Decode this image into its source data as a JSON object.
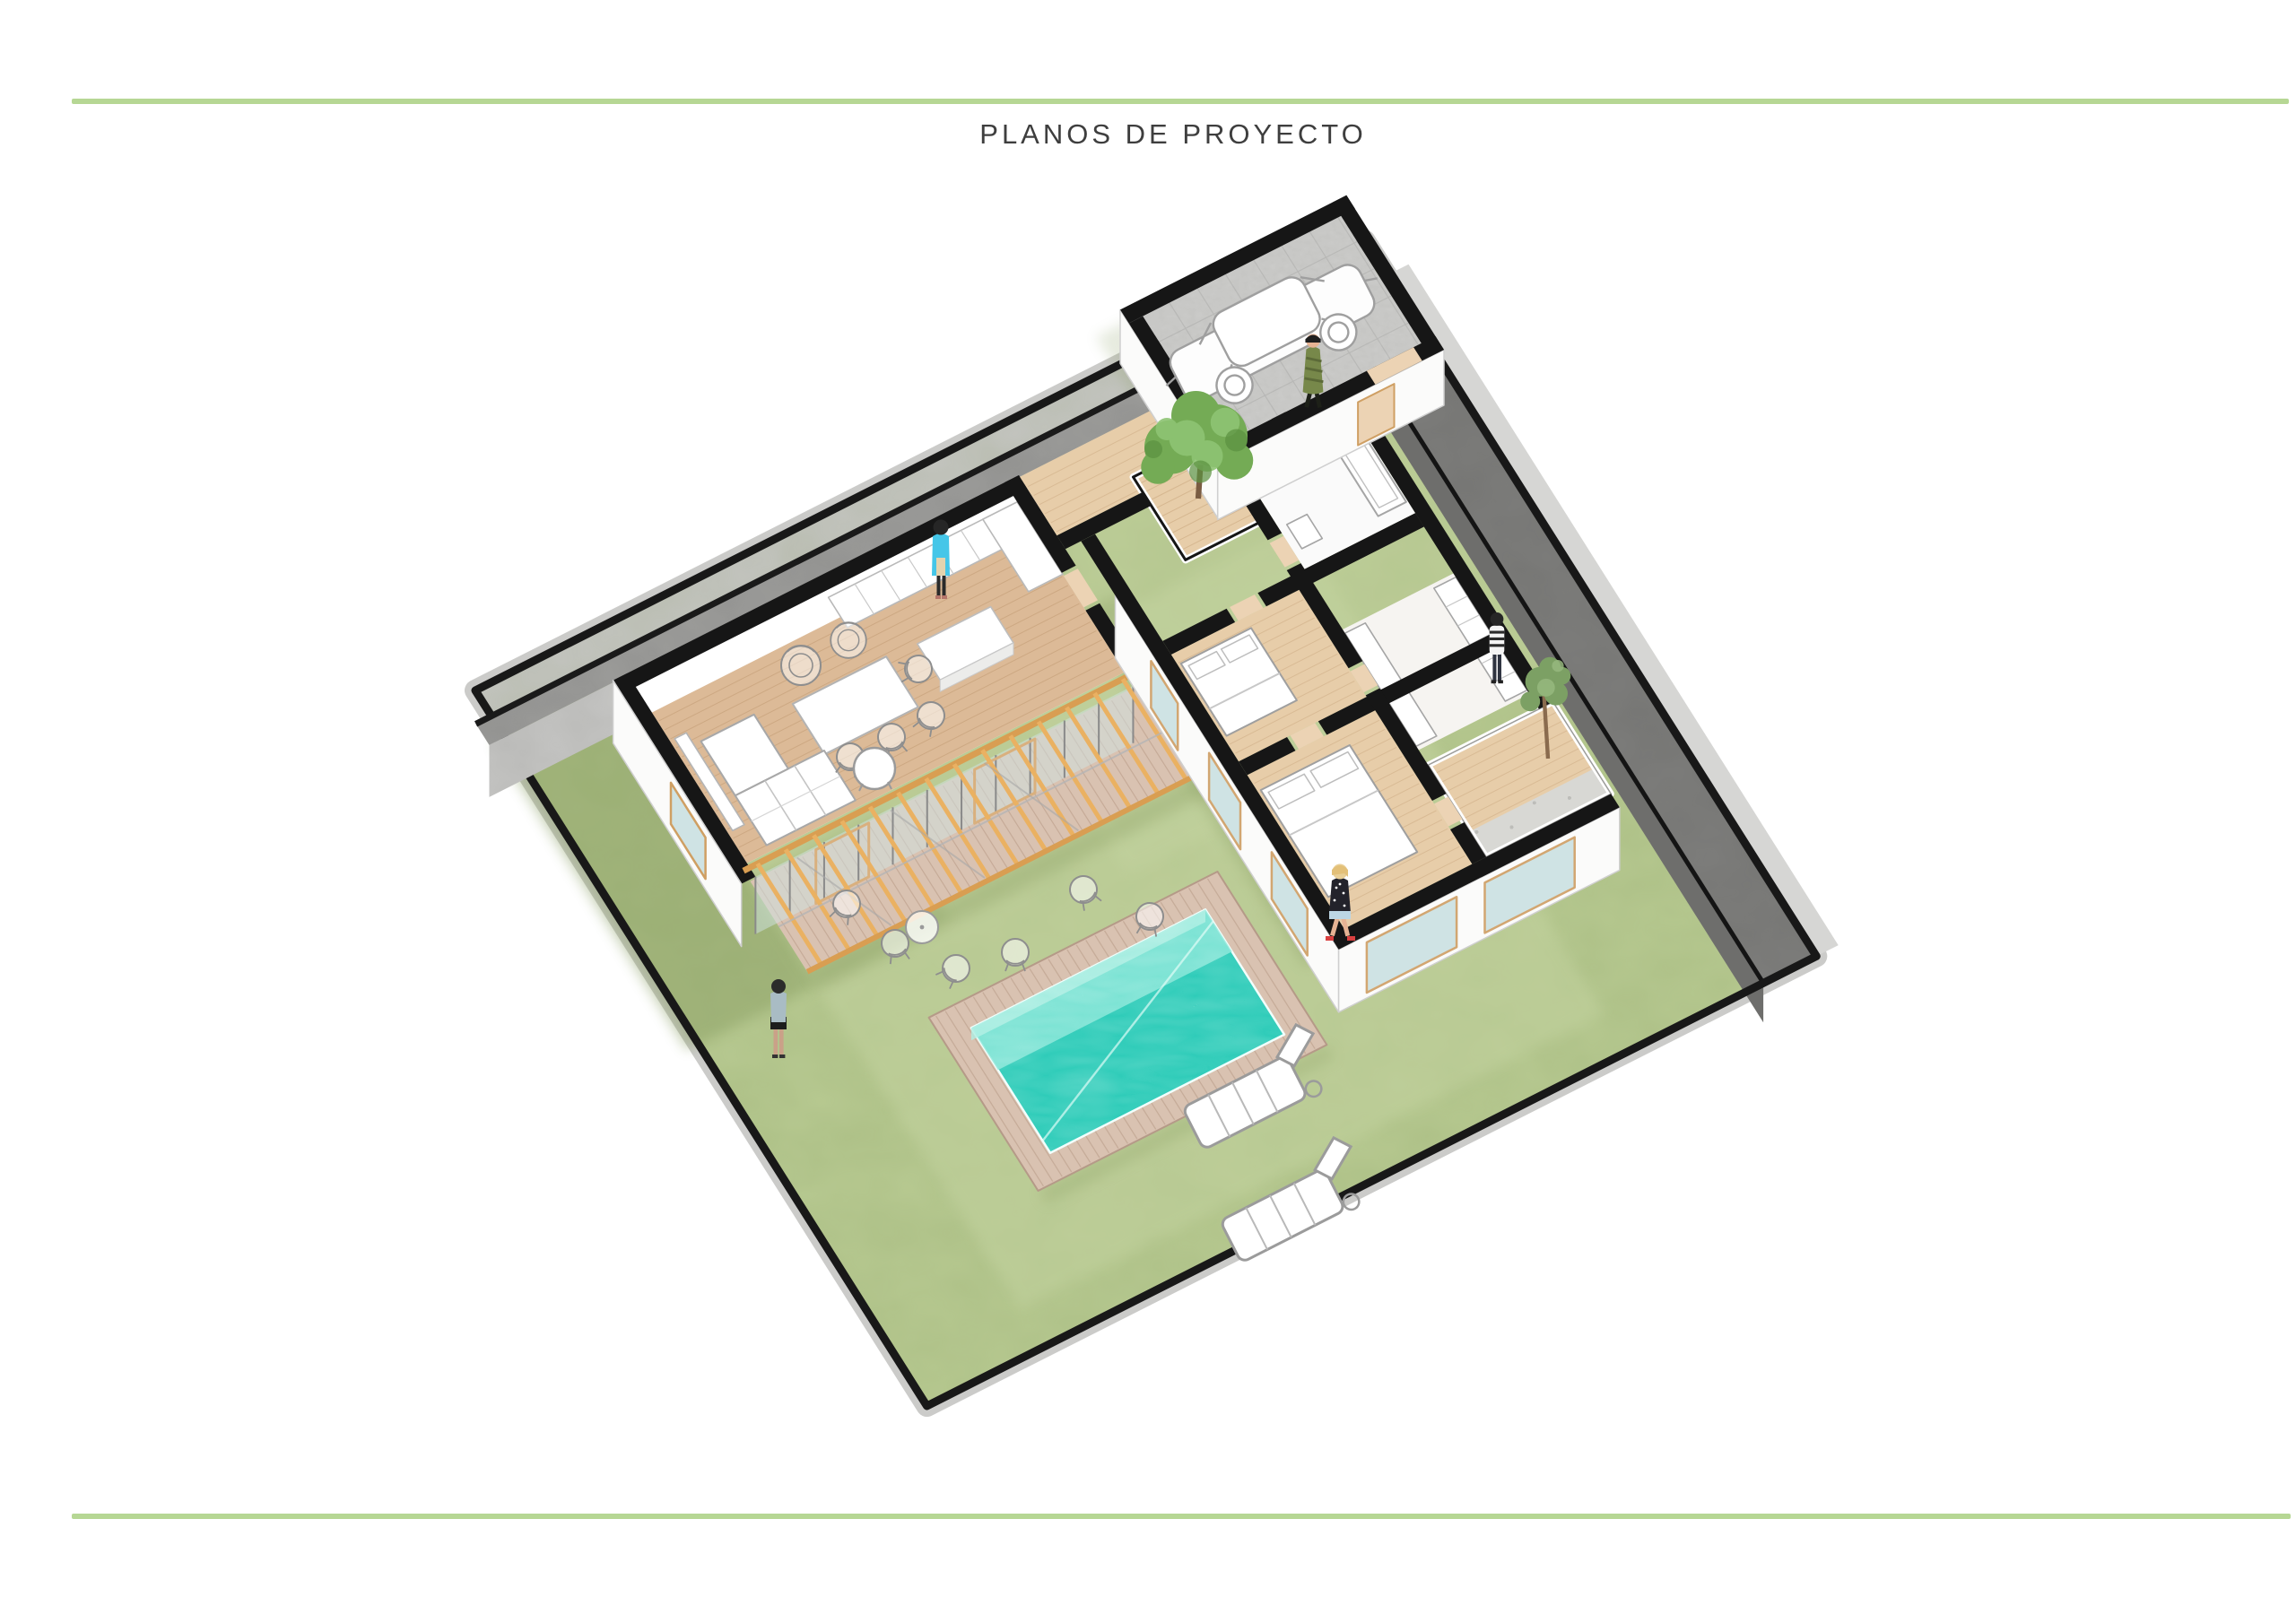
{
  "page": {
    "title": "PLANOS DE PROYECTO"
  },
  "colors": {
    "accent_line": "#b6d794",
    "title_text": "#3e3e3e",
    "lawn": "#b8ca92",
    "lawn_light": "#c6d5a3",
    "lawn_shade": "#879c60",
    "concrete_path": "#c6c6c4",
    "concrete_wall": "#a0a09e",
    "concrete_wall_face": "#c9c9c7",
    "boundary_wall_dark": "#7f7f7d",
    "section_cut_black": "#161616",
    "exterior_wall_white": "#fbfbfa",
    "wood_floor": "#dcba97",
    "wood_floor_light": "#e7cda9",
    "wood_deck": "#d9c2b1",
    "pool_deep": "#2fccb9",
    "pool_shallow": "#8ae6d8",
    "pergola_wood": "#eab162",
    "tree_green": "#74ab55",
    "glass": "#cfe3e4",
    "door_beige": "#ecd3b4"
  },
  "scene": {
    "kind": "axonometric cutaway rendering",
    "subject": "single-storey house with garden, pergola terrace and swimming pool",
    "objects": [
      "boundary-walls",
      "concrete-path",
      "lawn",
      "living-dining-kitchen-wing",
      "pergola-terrace",
      "wood-deck",
      "swimming-pool",
      "pool-deck",
      "bedroom-wing",
      "bathroom",
      "walk-in-closet",
      "interior-courtyard-tree",
      "side-courtyard-tree",
      "garage-with-car",
      "sun-loungers",
      "garden-chairs",
      "dining-set",
      "sofa",
      "kitchen-counters",
      "five-people"
    ]
  }
}
